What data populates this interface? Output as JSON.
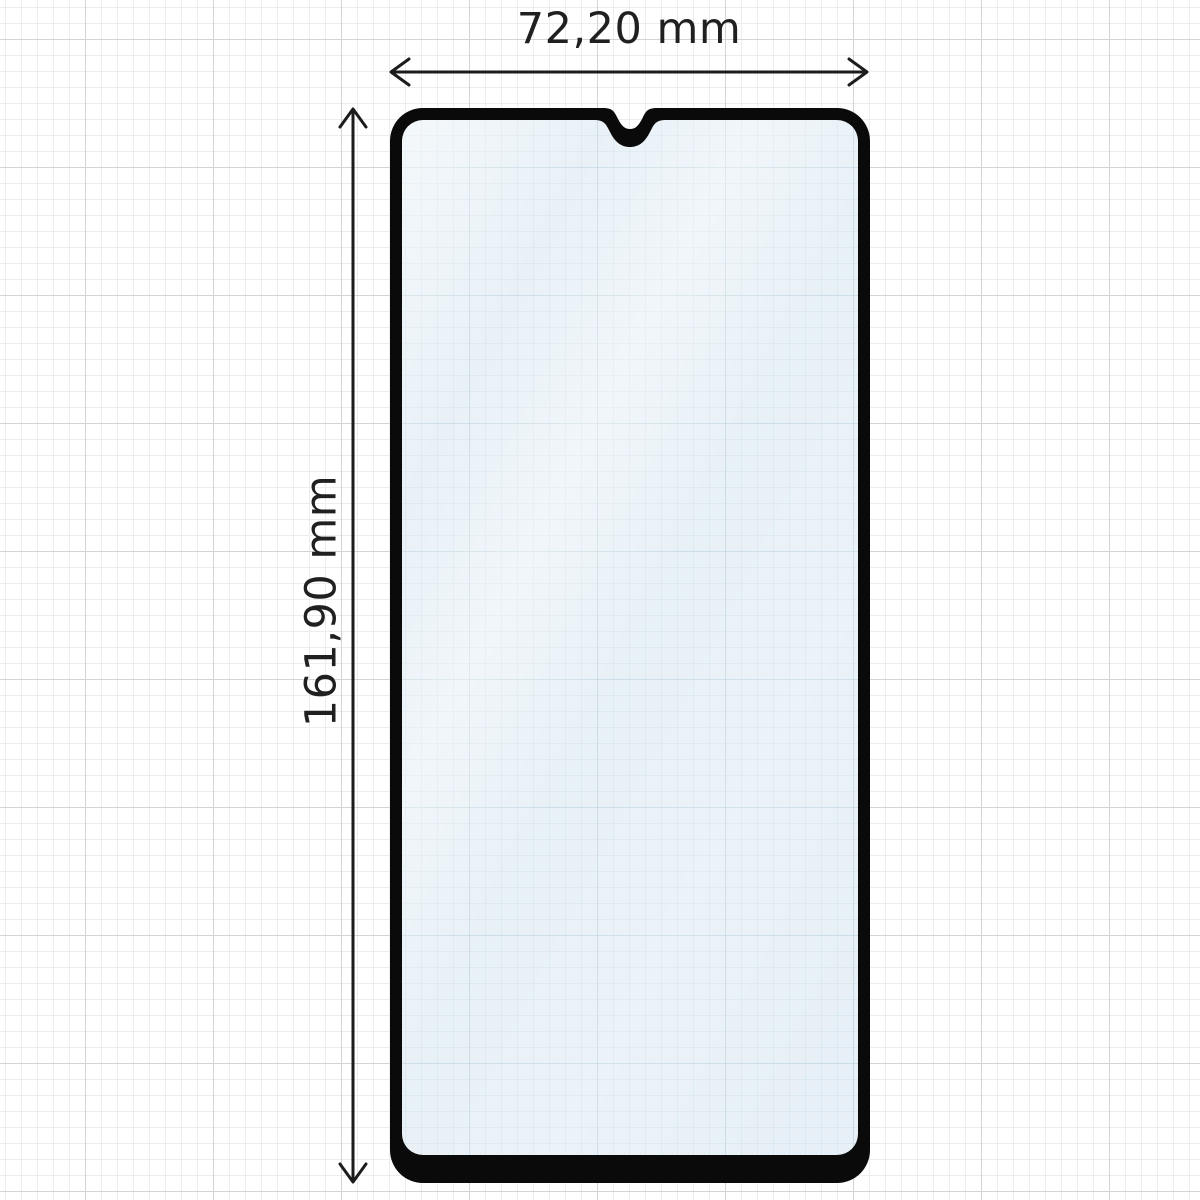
{
  "dimensions": {
    "width_label": "72,20 mm",
    "height_label": "161,90 mm"
  },
  "colors": {
    "frame_black": "#0a0a0a",
    "glass_tint": "#e7f0f6",
    "glass_grid_minor": "#cddfe9",
    "glass_grid_major": "#b7cfdd",
    "paper_grid_minor": "#ededed",
    "paper_grid_major": "#d4d4d4",
    "dimension_lines": "#1c1c1c",
    "label_text": "#202020"
  }
}
